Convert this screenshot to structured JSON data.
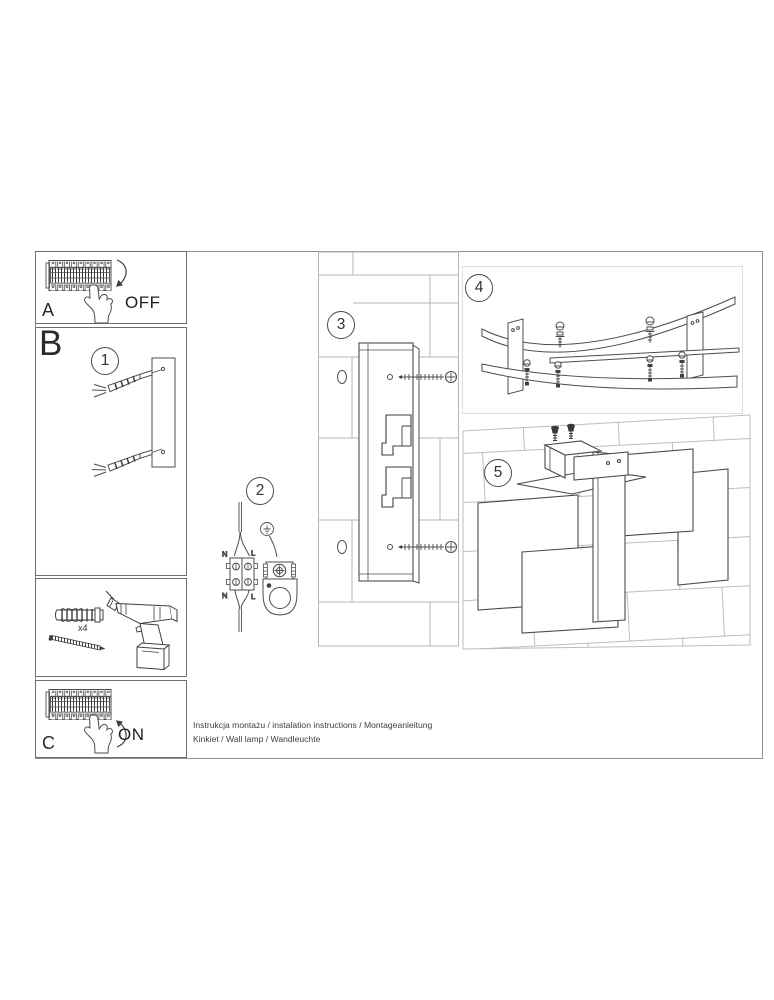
{
  "document": {
    "footer": {
      "line1": "Instrukcja montażu / instalation instructions / Montageanleitung",
      "line2": "Kinkiet / Wall lamp / Wandleuchte"
    }
  },
  "panels": {
    "a": {
      "label": "A",
      "state": "OFF"
    },
    "b": {
      "label": "B"
    },
    "c": {
      "label": "C",
      "state": "ON"
    },
    "tools": {
      "quantity": "x4"
    }
  },
  "steps": {
    "one": "1",
    "two": "2",
    "three": "3",
    "four": "4",
    "five": "5"
  },
  "wiring": {
    "top_left": "N",
    "top_right": "L",
    "bottom_left": "N",
    "bottom_right": "L"
  },
  "colors": {
    "ink": "#4d4d4d",
    "brick_line": "#b5b5b5",
    "frame": "#909090"
  }
}
